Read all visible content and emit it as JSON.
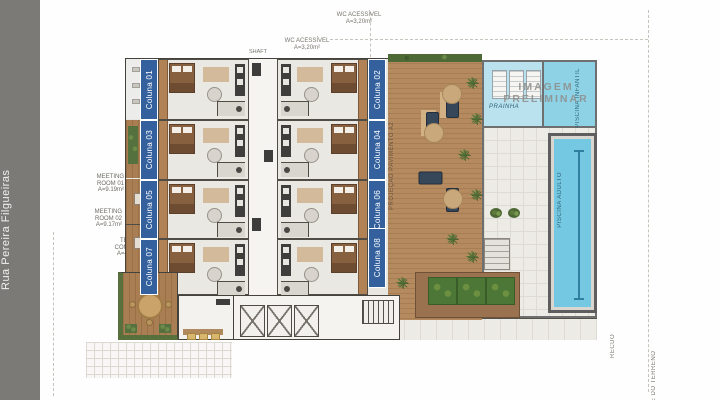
{
  "street": {
    "name": "Rua Pereira Filgueiras"
  },
  "watermark": {
    "line1": "IMAGEM",
    "line2": "PRELIMINAR"
  },
  "units": {
    "left": [
      "Coluna 01",
      "Coluna 03",
      "Coluna 05",
      "Coluna 07"
    ],
    "right": [
      "Coluna 02",
      "Coluna 04",
      "Coluna 06",
      "Coluna 08"
    ]
  },
  "labels": {
    "wc_top": {
      "title": "WC ACESSÍVEL",
      "area": "A=3,20m²"
    },
    "wc_mid": {
      "title": "WC ACESSÍVEL",
      "area": "A=3,20m²"
    },
    "shaft": "SHAFT",
    "meeting1": {
      "l1": "MEETING",
      "l2": "ROOM  01",
      "l3": "A=9.19m²"
    },
    "meeting2": {
      "l1": "MEETING",
      "l2": "ROOM  02",
      "l3": "A=9.17m²"
    },
    "terrace": {
      "l1": "TERR.",
      "l2": "COMUM",
      "l3": "A=45m²"
    },
    "deck_projection": "PROJEÇÃO PAVIMENTO A2",
    "recuo": "RECUO",
    "limite": "LIMITE DO TERRENO"
  },
  "pool": {
    "adult": "PISCINA ADULTO",
    "infant": "PISCINA INFANTIL",
    "beach": "PRAINHA"
  },
  "colors": {
    "street_gray": "#7c7a77",
    "label_blue": "#34619e",
    "pool": "#74c8e1",
    "infant": "#8ed2e6",
    "beach": "#b9e1ee",
    "deck_wood": "#b68a5f",
    "hedge": "#55713d",
    "watermark": "#8f8d8a"
  }
}
